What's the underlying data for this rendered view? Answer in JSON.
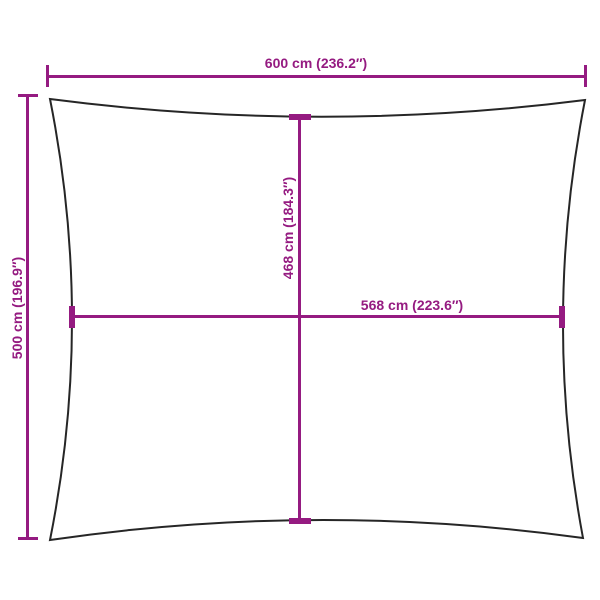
{
  "diagram": {
    "title": "shade-sail-dimension-diagram",
    "outer_width_label": "600 cm (236.2″)",
    "outer_height_label": "500 cm (196.9″)",
    "inner_height_label": "468 cm (184.3″)",
    "inner_width_label": "568 cm (223.6″)"
  },
  "colors": {
    "dimension": "#951B81",
    "outline": "#262626",
    "background": "#FFFFFF"
  }
}
